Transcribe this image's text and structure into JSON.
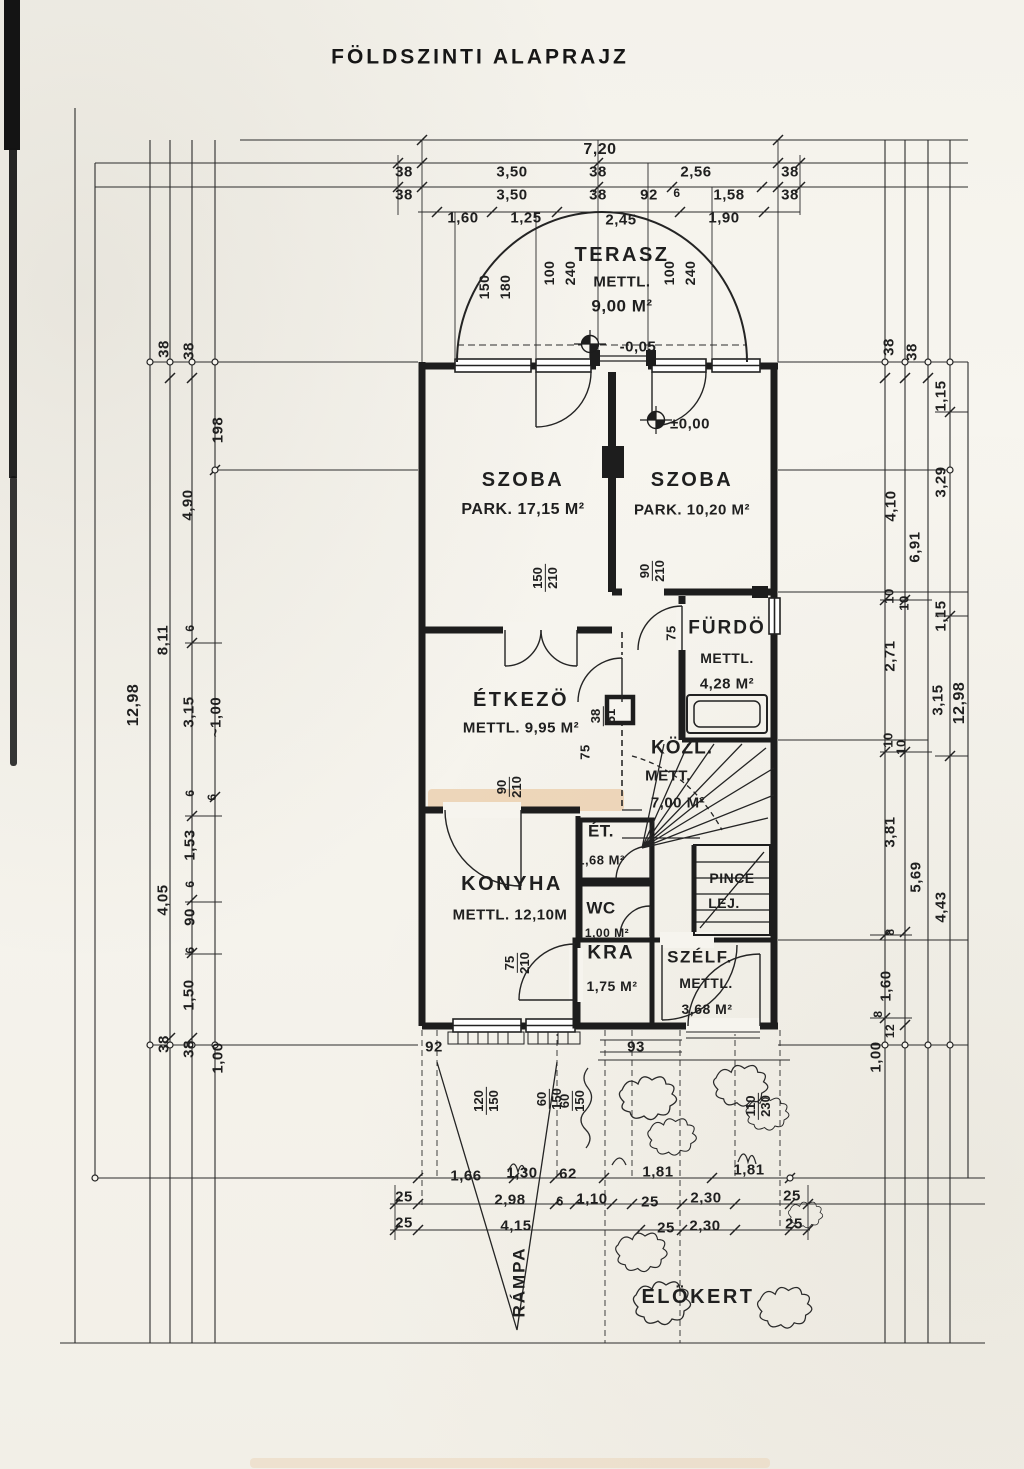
{
  "title": "FÖLDSZINTI  ALAPRAJZ",
  "colors": {
    "paper": "#f6f4ee",
    "ink": "#262626",
    "smudge": "#e9c9a4"
  },
  "rooms": {
    "terasz": {
      "name": "TERASZ",
      "sub": "METTL.",
      "area": "9,00 M²",
      "level": "-0,05"
    },
    "szoba1": {
      "name": "SZOBA",
      "detail": "PARK.  17,15 M²"
    },
    "szoba2": {
      "name": "SZOBA",
      "detail": "PARK.  10,20 M²",
      "level": "±0,00"
    },
    "furdo": {
      "name": "FÜRDÖ",
      "sub": "METTL.",
      "area": "4,28 M²"
    },
    "etkezo": {
      "name": "ÉTKEZÖ",
      "detail": "METTL. 9,95 M²"
    },
    "kozl": {
      "name": "KÖZL.",
      "sub": "METT.",
      "area": "7,00 M²"
    },
    "et": {
      "name": "ÉT.",
      "area": "1,68 M²"
    },
    "konyha": {
      "name": "KONYHA",
      "detail": "METTL. 12,10M"
    },
    "wc": {
      "name": "WC",
      "area": "1,00 M²"
    },
    "pince": {
      "line1": "PINCE",
      "line2": "LEJ."
    },
    "kamra": {
      "name": "KRA",
      "area": "1,75 M²"
    },
    "szelfogo": {
      "name": "SZÉLF.",
      "sub": "METTL.",
      "area": "3,68 M²"
    },
    "rampa": {
      "name": "RÁMPA"
    },
    "elokert": {
      "name": "ELÖKERT"
    }
  },
  "dims": {
    "top": {
      "total": "7,20",
      "row2": [
        "38",
        "3,50",
        "38",
        "2,56",
        "38"
      ],
      "row3": [
        "38",
        "3,50",
        "38",
        "92",
        "6",
        "1,58",
        "38"
      ],
      "row4": [
        "1,60",
        "1,25",
        "2,45",
        "1,90"
      ]
    },
    "terasz": [
      "150",
      "180",
      "100",
      "240",
      "100",
      "240"
    ],
    "left": {
      "total": "12,98",
      "c1": [
        "38",
        "8,11",
        "4,05",
        "38"
      ],
      "c2": [
        "38",
        "4,90",
        "6",
        "3,15",
        "6",
        "1,53",
        "6",
        "90",
        "6",
        "1,50",
        "38"
      ],
      "c3": [
        "198",
        "~1,00",
        "6",
        "1,00"
      ]
    },
    "right": {
      "total": "12,98",
      "c1": [
        "38",
        "4,10",
        "10",
        "2,71",
        "10",
        "3,81",
        "8",
        "1,60",
        "8",
        "12",
        "1,00"
      ],
      "c2": [
        "38",
        "6,91",
        "10",
        "10",
        "5,69"
      ],
      "c3": [
        "1,15",
        "3,29",
        "1,15",
        "3,15",
        "4,43"
      ]
    },
    "doors": {
      "szoba1": [
        "150",
        "210"
      ],
      "szoba2": [
        "90",
        "210"
      ],
      "furdo": "75",
      "kozl": "75",
      "niche": [
        "38",
        "51"
      ],
      "konyha": [
        "90",
        "210"
      ],
      "kamra": [
        "75",
        "210"
      ]
    },
    "bottom": {
      "w1": "92",
      "w2": "93",
      "win1": [
        "120",
        "150"
      ],
      "win2": [
        "60",
        "150"
      ],
      "win3": [
        "60",
        "150"
      ],
      "door": [
        "110",
        "230"
      ],
      "rowA": [
        "1,66",
        "1,30",
        "62",
        "1,81",
        "1,81"
      ],
      "rowB": [
        "25",
        "2,98",
        "6",
        "1,10",
        "25",
        "2,30",
        "25"
      ],
      "rowC": [
        "25",
        "4,15",
        "25",
        "2,30",
        "25"
      ]
    }
  }
}
